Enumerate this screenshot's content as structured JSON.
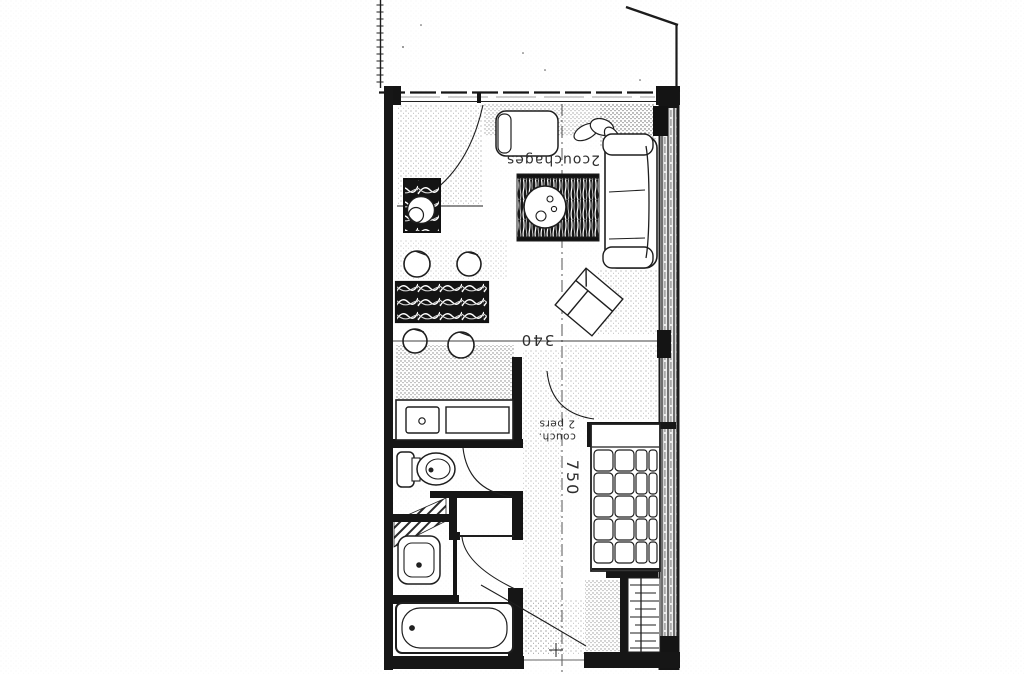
{
  "page": {
    "paper_color": "#ffffff",
    "ink_color": "#1c1c1c"
  },
  "plan": {
    "labels": {
      "living_sleeps": "2couchages",
      "living_width_cm": "340",
      "bed_label_line1": "couch.",
      "bed_label_line2": "2 pers",
      "apartment_length_cm": "750"
    },
    "furniture_icons": [
      "balcony-rail",
      "window-wall",
      "door-swing",
      "armchair",
      "potted-plant",
      "sofa",
      "radiator",
      "tv-cabinet",
      "rug",
      "coffee-table",
      "bar-stool",
      "bar-counter",
      "lounge-chair",
      "kitchen-sink",
      "cooktop",
      "toilet",
      "closet",
      "duct-hatch",
      "washbasin",
      "bathtub",
      "double-bed",
      "wardrobe",
      "entry-door",
      "center-line"
    ]
  }
}
